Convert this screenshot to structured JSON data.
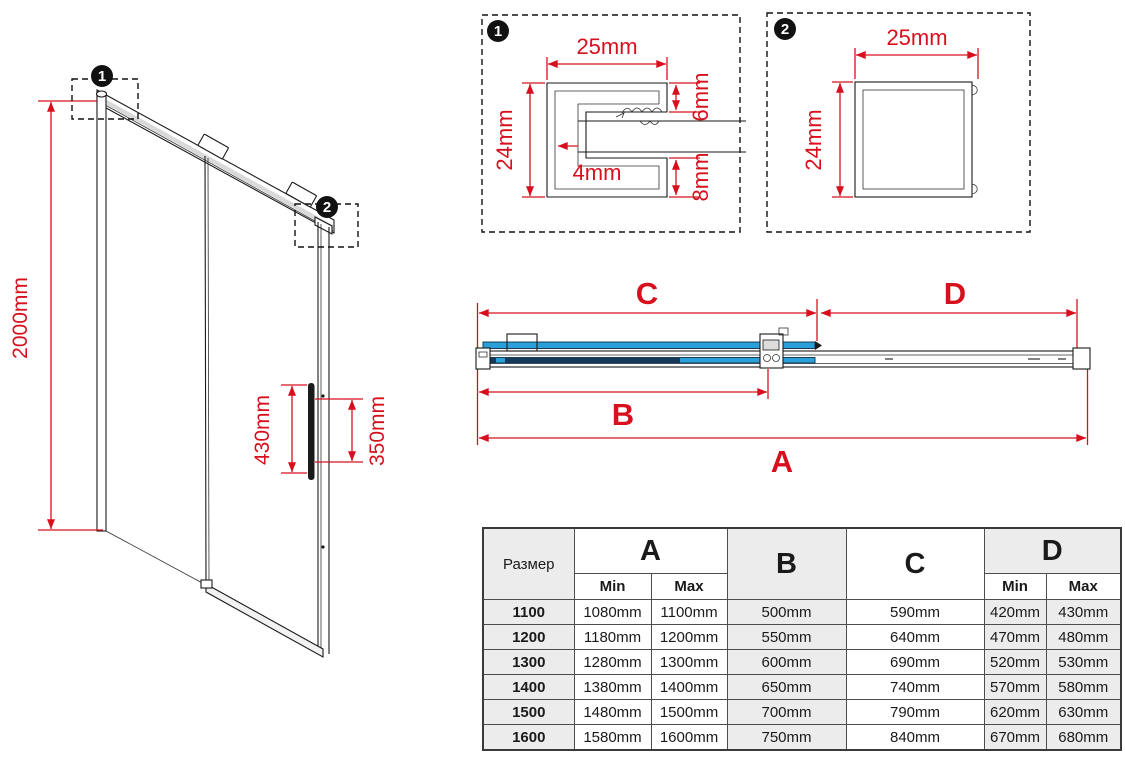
{
  "colors": {
    "red": "#d8101e",
    "blue": "#2b9fd8",
    "dark_blue": "#173a5c",
    "grey_cell": "#ececec",
    "line_black": "#1a1a1a"
  },
  "door": {
    "height": "2000mm",
    "handle_length": "430mm",
    "handle_holes": "350mm",
    "callout_1": "1",
    "callout_2": "2"
  },
  "detail_1": {
    "badge": "1",
    "width": "25mm",
    "height": "24mm",
    "top_lip": "6mm",
    "wall": "4mm",
    "bottom_lip": "8mm"
  },
  "detail_2": {
    "badge": "2",
    "width": "25mm",
    "height": "24mm"
  },
  "plan": {
    "a": "A",
    "b": "B",
    "c": "C",
    "d": "D"
  },
  "table": {
    "size_header": "Размер",
    "min": "Min",
    "max": "Max",
    "cols": {
      "a": "A",
      "b": "B",
      "c": "C",
      "d": "D"
    },
    "rows": [
      {
        "size": "1100",
        "a_min": "1080mm",
        "a_max": "1100mm",
        "b": "500mm",
        "c": "590mm",
        "d_min": "420mm",
        "d_max": "430mm"
      },
      {
        "size": "1200",
        "a_min": "1180mm",
        "a_max": "1200mm",
        "b": "550mm",
        "c": "640mm",
        "d_min": "470mm",
        "d_max": "480mm"
      },
      {
        "size": "1300",
        "a_min": "1280mm",
        "a_max": "1300mm",
        "b": "600mm",
        "c": "690mm",
        "d_min": "520mm",
        "d_max": "530mm"
      },
      {
        "size": "1400",
        "a_min": "1380mm",
        "a_max": "1400mm",
        "b": "650mm",
        "c": "740mm",
        "d_min": "570mm",
        "d_max": "580mm"
      },
      {
        "size": "1500",
        "a_min": "1480mm",
        "a_max": "1500mm",
        "b": "700mm",
        "c": "790mm",
        "d_min": "620mm",
        "d_max": "630mm"
      },
      {
        "size": "1600",
        "a_min": "1580mm",
        "a_max": "1600mm",
        "b": "750mm",
        "c": "840mm",
        "d_min": "670mm",
        "d_max": "680mm"
      }
    ]
  }
}
